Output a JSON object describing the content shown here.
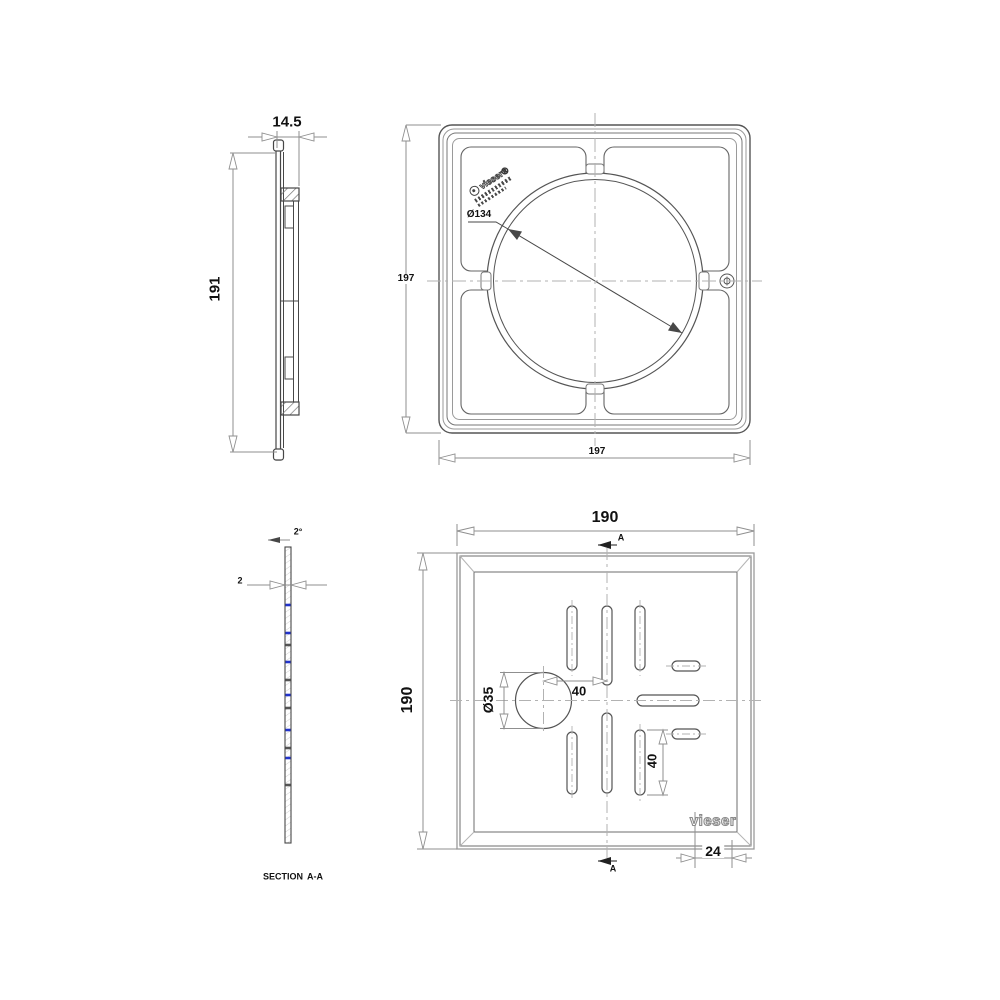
{
  "drawing": {
    "side_view": {
      "width_dim": "14.5",
      "height_dim": "191"
    },
    "frame_plan": {
      "size_dim_left": "197",
      "size_dim_bottom": "197",
      "circle_dim": "Ø134",
      "stamp_brand": "vieser®"
    },
    "section_view": {
      "thickness_dim": "2",
      "draft_angle_dim": "2°",
      "caption_section": "SECTION",
      "caption_name": "A-A"
    },
    "grate_plan": {
      "width_dim": "190",
      "height_dim": "190",
      "hole_dim": "Ø35",
      "offset_dim": "40",
      "slot_length_dim": "40",
      "corner_dim": "24",
      "section_label_top": "A",
      "section_label_bottom": "A",
      "logo_text": "vieser"
    },
    "colors": {
      "line_dark": "#474747",
      "line_medium": "#8f8f8f",
      "centerline": "#b2b2b2",
      "section_tick_blue": "#2233cc",
      "text": "#111111",
      "background": "#ffffff"
    }
  }
}
